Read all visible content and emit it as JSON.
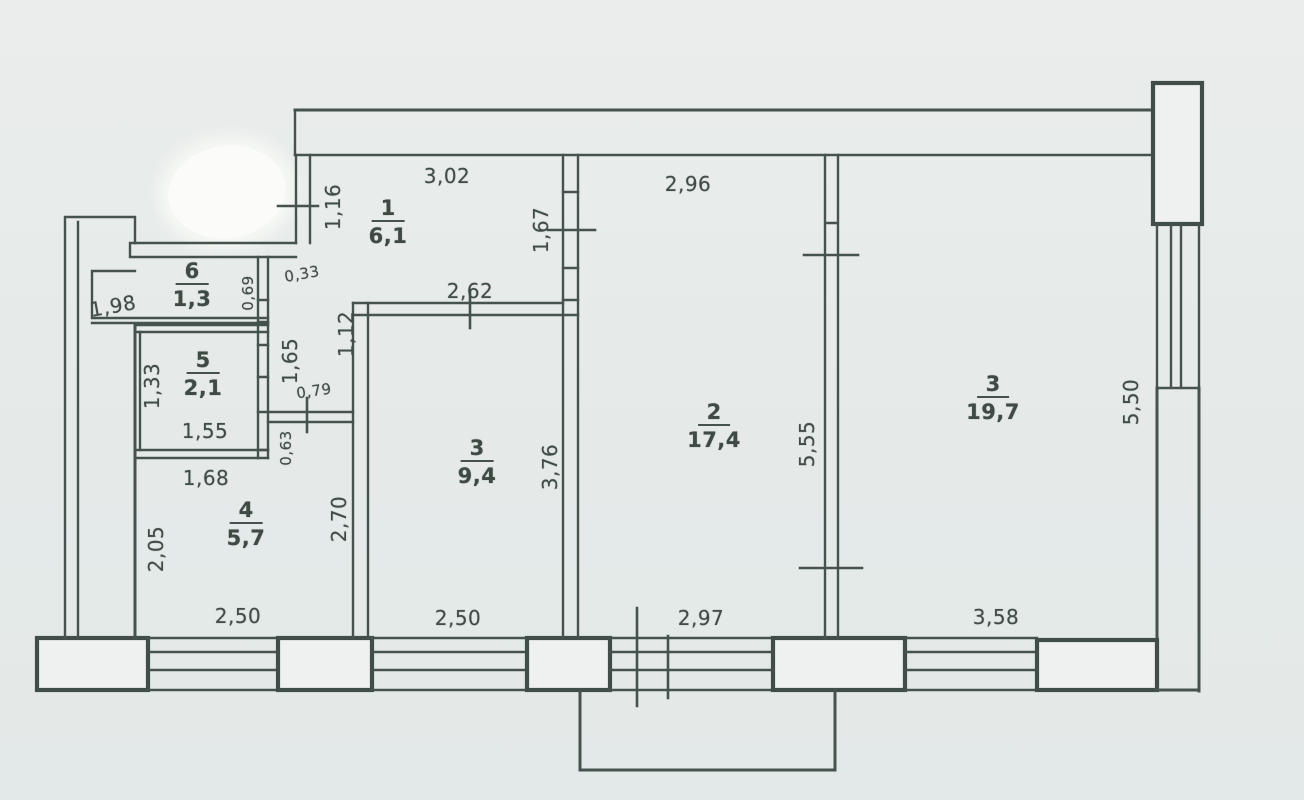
{
  "plan": {
    "colors": {
      "line": "#46524d",
      "paper": "#e6eae9",
      "pillar_fill": "#eef1ef",
      "text": "#414c47"
    },
    "rooms": [
      {
        "number": "1",
        "area": "6,1"
      },
      {
        "number": "2",
        "area": "17,4"
      },
      {
        "number": "3",
        "area": "9,4"
      },
      {
        "number": "3",
        "area": "19,7"
      },
      {
        "number": "4",
        "area": "5,7"
      },
      {
        "number": "5",
        "area": "2,1"
      },
      {
        "number": "6",
        "area": "1,3"
      }
    ],
    "dimensions": [
      {
        "text": "3,02"
      },
      {
        "text": "2,96"
      },
      {
        "text": "2,62"
      },
      {
        "text": "1,98"
      },
      {
        "text": "0,33"
      },
      {
        "text": "0,79"
      },
      {
        "text": "1,55"
      },
      {
        "text": "1,68"
      },
      {
        "text": "2,50"
      },
      {
        "text": "2,50"
      },
      {
        "text": "2,97"
      },
      {
        "text": "3,58"
      },
      {
        "text": "1,16"
      },
      {
        "text": "1,67"
      },
      {
        "text": "0,69"
      },
      {
        "text": "1,12"
      },
      {
        "text": "1,65"
      },
      {
        "text": "0,63"
      },
      {
        "text": "1,33"
      },
      {
        "text": "2,05"
      },
      {
        "text": "2,70"
      },
      {
        "text": "3,76"
      },
      {
        "text": "5,55"
      },
      {
        "text": "5,50"
      }
    ]
  }
}
